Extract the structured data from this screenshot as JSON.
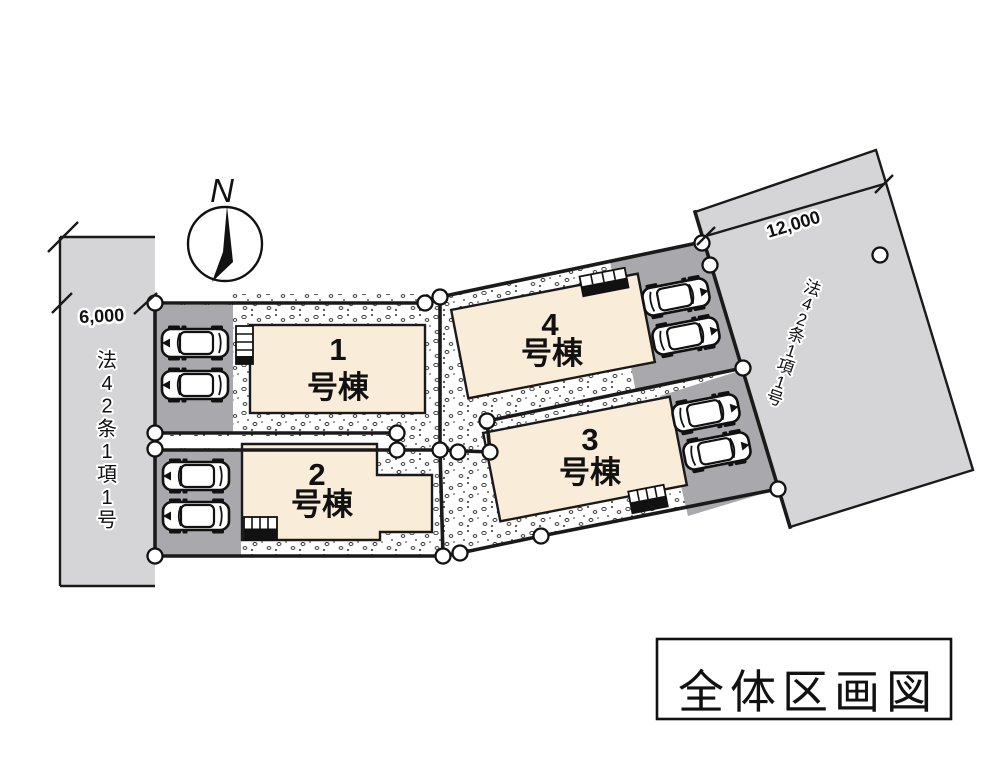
{
  "diagram": {
    "type": "site-plan",
    "title_box": {
      "label": "全体区画図"
    },
    "compass": {
      "label": "N"
    },
    "roads": {
      "left": {
        "dimension": "6,000",
        "law": "法42条1項1号"
      },
      "right": {
        "dimension": "12,000",
        "law": "法42条1項1号"
      }
    },
    "buildings": [
      {
        "number": "1",
        "suffix": "号棟"
      },
      {
        "number": "2",
        "suffix": "号棟"
      },
      {
        "number": "3",
        "suffix": "号棟"
      },
      {
        "number": "4",
        "suffix": "号棟"
      }
    ],
    "colors": {
      "road": "#d5d5d7",
      "parking": "#a9a9ad",
      "building": "#f9ecd8",
      "line": "#1a1a1a"
    }
  }
}
